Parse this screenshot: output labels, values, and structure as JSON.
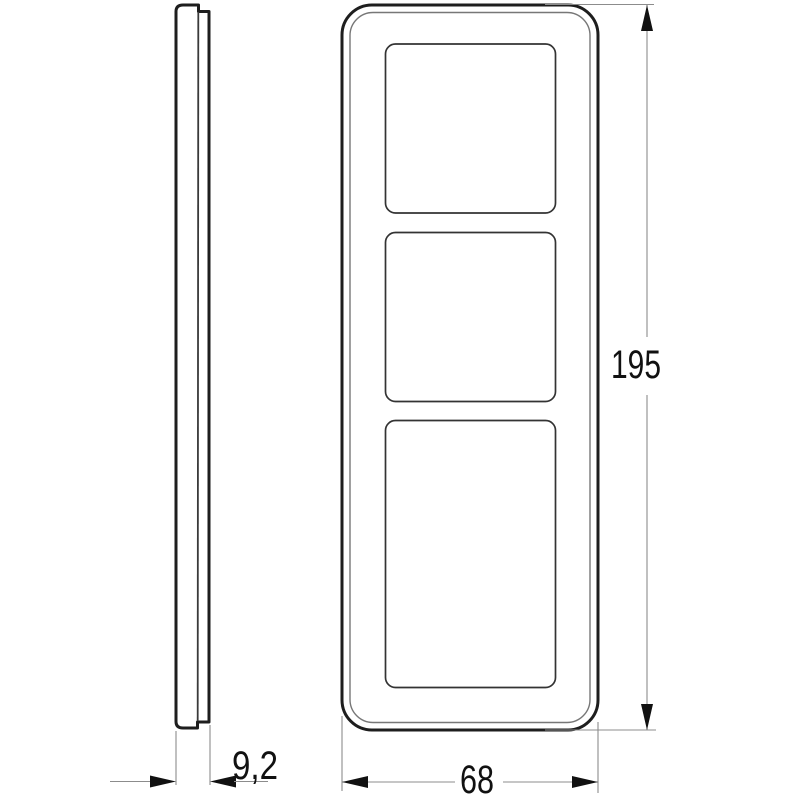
{
  "drawing": {
    "type": "technical-dimension-drawing",
    "background_color": "#ffffff",
    "contour_color": "#1e1e1e",
    "thin_line_color": "#777777",
    "dimension_line_color": "#8c8c8c",
    "text_color": "#111111",
    "views": {
      "side_view": {
        "description": "side-profile-of-frame"
      },
      "front_view": {
        "description": "front-view-three-gang-frame",
        "openings": 3
      }
    },
    "dimensions": {
      "depth": {
        "label": "9,2"
      },
      "height": {
        "label": "195"
      },
      "width": {
        "label": "68"
      }
    }
  }
}
